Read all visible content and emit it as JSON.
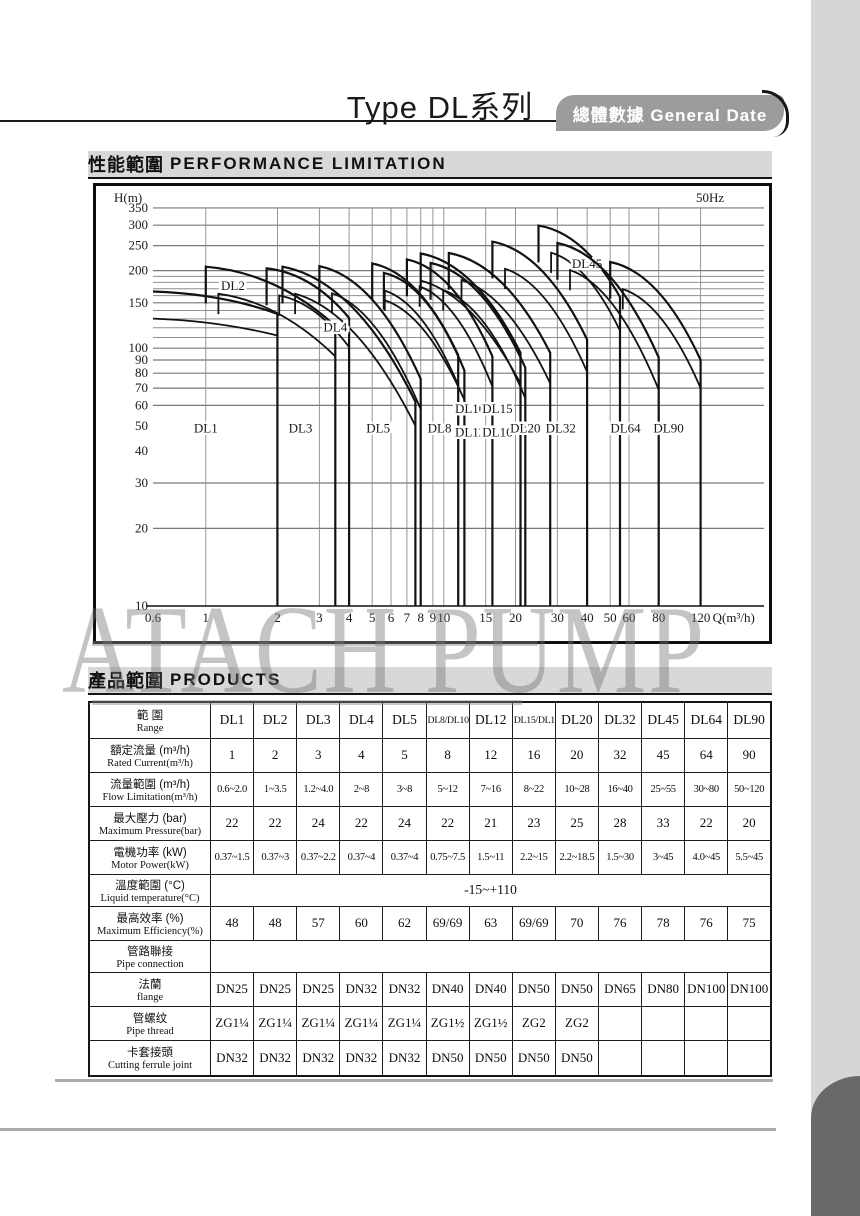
{
  "page": {
    "title": "Type DL系列",
    "tab_label": "總體數據 General Date"
  },
  "sections": {
    "performance": {
      "zh": "性能範圍",
      "en": "PERFORMANCE LIMITATION"
    },
    "products": {
      "zh": "產品範圍",
      "en": "PRODUCTS"
    }
  },
  "watermark": "ATACH PUMP",
  "chart_data": {
    "type": "line",
    "title": "性能範圍 PERFORMANCE LIMITATION",
    "frequency_label": "50Hz",
    "xlabel": "Q(m³/h)",
    "ylabel": "H(m)",
    "x_scale": "log",
    "y_scale": "log",
    "xlim": [
      0.6,
      135
    ],
    "ylim": [
      10,
      350
    ],
    "x_ticks": [
      0.6,
      1,
      2,
      3,
      4,
      5,
      6,
      7,
      8,
      9,
      10,
      15,
      20,
      30,
      40,
      50,
      60,
      80,
      120
    ],
    "y_ticks": [
      350,
      300,
      250,
      200,
      150,
      100,
      90,
      80,
      70,
      60,
      50,
      40,
      30,
      20,
      10
    ],
    "h_gridlines": [
      20,
      30,
      60,
      70,
      80,
      90,
      100,
      110,
      120,
      130,
      140,
      150,
      160,
      170,
      180,
      190,
      200,
      250,
      300,
      350
    ],
    "h_gridlines_major": [
      20,
      30,
      60,
      70,
      80,
      90,
      100,
      150,
      200,
      250,
      300,
      350
    ],
    "grid": true,
    "legend": "inline-labels",
    "models": [
      {
        "name": "DL1",
        "qmin": 0.6,
        "qmax": 2.0,
        "peak": 166,
        "topEnd": 136,
        "lowEnd": 112,
        "labelQ": 1.0,
        "labelH": 47,
        "leftVert": false,
        "innerVert": false
      },
      {
        "name": "DL2",
        "qmin": 1.0,
        "qmax": 3.5,
        "peak": 207,
        "topEnd": 122,
        "lowEnd": 93,
        "labelQ": 1.3,
        "labelH": 168,
        "leftVert": true,
        "innerVert": true
      },
      {
        "name": "DL3",
        "qmin": 1.8,
        "qmax": 4.0,
        "peak": 204,
        "topEnd": 131,
        "lowEnd": 101,
        "labelQ": 2.5,
        "labelH": 47,
        "leftVert": true,
        "innerVert": true
      },
      {
        "name": "DL4",
        "qmin": 2.1,
        "qmax": 7.6,
        "peak": 207,
        "topEnd": 62,
        "lowEnd": 50,
        "labelQ": 3.5,
        "labelH": 116,
        "leftVert": true,
        "innerVert": true
      },
      {
        "name": "DL5",
        "qmin": 3.0,
        "qmax": 8.0,
        "peak": 208,
        "topEnd": 76,
        "lowEnd": 58,
        "labelQ": 5.3,
        "labelH": 47,
        "leftVert": true,
        "innerVert": true
      },
      {
        "name": "DL8",
        "qmin": 5.0,
        "qmax": 11.5,
        "peak": 213,
        "topEnd": 94,
        "lowEnd": 72,
        "labelQ": 9.6,
        "labelH": 47,
        "leftVert": true,
        "innerVert": true
      },
      {
        "name": "DL10",
        "qmin": 5.6,
        "qmax": 12.2,
        "peak": 196,
        "topEnd": 82,
        "lowEnd": 63,
        "labelQ": 12.9,
        "labelH": 56,
        "leftVert": true,
        "innerVert": false
      },
      {
        "name": "DL12",
        "qmin": 7.0,
        "qmax": 16.0,
        "peak": 221,
        "topEnd": 93,
        "lowEnd": 71,
        "labelQ": 12.9,
        "labelH": 45.5,
        "leftVert": true,
        "innerVert": true
      },
      {
        "name": "DL15",
        "qmin": 8.0,
        "qmax": 21.0,
        "peak": 233,
        "topEnd": 96,
        "lowEnd": 73,
        "labelQ": 16.8,
        "labelH": 56,
        "leftVert": true,
        "innerVert": false
      },
      {
        "name": "DL16",
        "qmin": 8.8,
        "qmax": 22.0,
        "peak": 214,
        "topEnd": 84,
        "lowEnd": 64,
        "labelQ": 16.8,
        "labelH": 45.5,
        "leftVert": true,
        "innerVert": true
      },
      {
        "name": "DL20",
        "qmin": 10.5,
        "qmax": 28.0,
        "peak": 234,
        "topEnd": 96,
        "lowEnd": 73,
        "labelQ": 22,
        "labelH": 47,
        "leftVert": true,
        "innerVert": true
      },
      {
        "name": "DL32",
        "qmin": 16.0,
        "qmax": 40.0,
        "peak": 259,
        "topEnd": 108,
        "lowEnd": 81,
        "labelQ": 31,
        "labelH": 47,
        "leftVert": true,
        "innerVert": true
      },
      {
        "name": "DL45",
        "qmin": 25.0,
        "qmax": 55.0,
        "peak": 299,
        "topEnd": 158,
        "lowEnd": 117,
        "labelQ": 40,
        "labelH": 205,
        "leftVert": true,
        "innerVert": true
      },
      {
        "name": "DL64",
        "qmin": 30.0,
        "qmax": 80.0,
        "peak": 256,
        "topEnd": 92,
        "lowEnd": 69,
        "labelQ": 58,
        "labelH": 47,
        "leftVert": true,
        "innerVert": true
      },
      {
        "name": "DL90",
        "qmin": 50.0,
        "qmax": 120.0,
        "peak": 216,
        "topEnd": 90,
        "lowEnd": 70,
        "labelQ": 88,
        "labelH": 47,
        "leftVert": true,
        "innerVert": true
      }
    ]
  },
  "table": {
    "rows": [
      {
        "zh": "範  圍",
        "en": "Range",
        "header": true,
        "values": [
          "DL1",
          "DL2",
          "DL3",
          "DL4",
          "DL5",
          "DL8/DL10",
          "DL12",
          "DL15/DL16",
          "DL20",
          "DL32",
          "DL45",
          "DL64",
          "DL90"
        ]
      },
      {
        "zh": "額定流量 (m³/h)",
        "en": "Rated Current(m³/h)",
        "values": [
          "1",
          "2",
          "3",
          "4",
          "5",
          "8",
          "12",
          "16",
          "20",
          "32",
          "45",
          "64",
          "90"
        ]
      },
      {
        "zh": "流量範圍 (m³/h)",
        "en": "Flow Limitation(m³/h)",
        "small": true,
        "values": [
          "0.6~2.0",
          "1~3.5",
          "1.2~4.0",
          "2~8",
          "3~8",
          "5~12",
          "7~16",
          "8~22",
          "10~28",
          "16~40",
          "25~55",
          "30~80",
          "50~120"
        ]
      },
      {
        "zh": "最大壓力 (bar)",
        "en": "Maximum Pressure(bar)",
        "values": [
          "22",
          "22",
          "24",
          "22",
          "24",
          "22",
          "21",
          "23",
          "25",
          "28",
          "33",
          "22",
          "20"
        ]
      },
      {
        "zh": "電機功率 (kW)",
        "en": "Motor Power(kW)",
        "small": true,
        "values": [
          "0.37~1.5",
          "0.37~3",
          "0.37~2.2",
          "0.37~4",
          "0.37~4",
          "0.75~7.5",
          "1.5~11",
          "2.2~15",
          "2.2~18.5",
          "1.5~30",
          "3~45",
          "4.0~45",
          "5.5~45"
        ]
      },
      {
        "zh": "溫度範圍 (°C)",
        "en": "Liquid temperature(°C)",
        "merged": "-15~+110",
        "short": true
      },
      {
        "zh": "最高效率 (%)",
        "en": "Maximum Efficiency(%)",
        "values": [
          "48",
          "48",
          "57",
          "60",
          "62",
          "69/69",
          "63",
          "69/69",
          "70",
          "76",
          "78",
          "76",
          "75"
        ]
      },
      {
        "zh": "管路聯接",
        "en": "Pipe connection",
        "merged": "",
        "short": true
      },
      {
        "zh": "法蘭",
        "en": "flange",
        "values": [
          "DN25",
          "DN25",
          "DN25",
          "DN32",
          "DN32",
          "DN40",
          "DN40",
          "DN50",
          "DN50",
          "DN65",
          "DN80",
          "DN100",
          "DN100"
        ]
      },
      {
        "zh": "管螺纹",
        "en": "Pipe thread",
        "values": [
          "ZG1¼",
          "ZG1¼",
          "ZG1¼",
          "ZG1¼",
          "ZG1¼",
          "ZG1½",
          "ZG1½",
          "ZG2",
          "ZG2",
          "",
          "",
          "",
          ""
        ]
      },
      {
        "zh": "卡套接頭",
        "en": "Cutting ferrule joint",
        "values": [
          "DN32",
          "DN32",
          "DN32",
          "DN32",
          "DN32",
          "DN50",
          "DN50",
          "DN50",
          "DN50",
          "",
          "",
          "",
          ""
        ]
      }
    ]
  }
}
